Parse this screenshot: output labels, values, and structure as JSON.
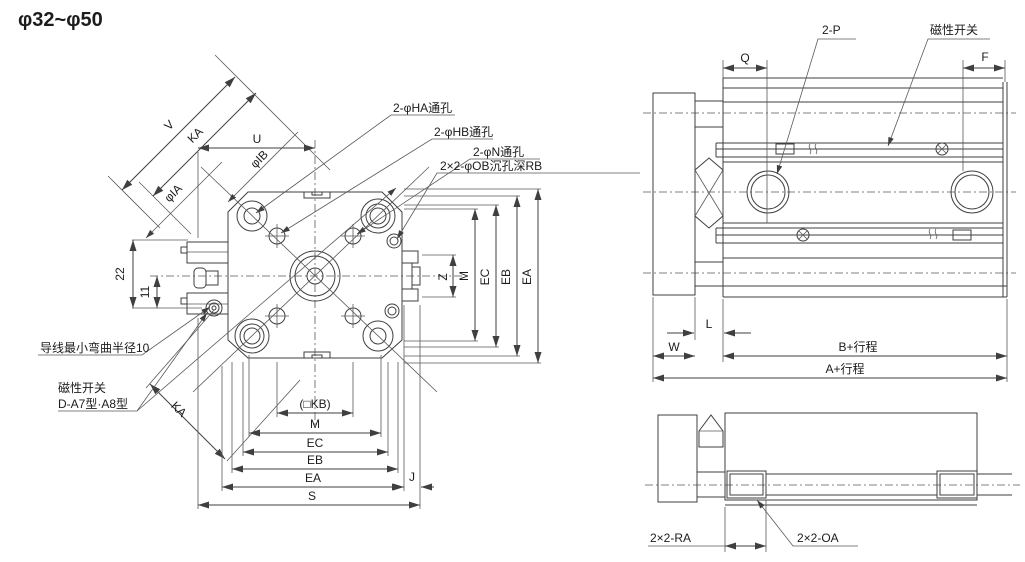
{
  "title": "φ32~φ50",
  "front_view": {
    "hole_labels": {
      "ha": "2-φHA通孔",
      "hb": "2-φHB通孔",
      "n": "2-φN通孔",
      "ob": "2×2-φOB沉孔深RB"
    },
    "annotations": {
      "wire_bend": "导线最小弯曲半径10",
      "switch_line1": "磁性开关",
      "switch_line2": "D-A7型·A8型"
    },
    "dimensions": {
      "v": "V",
      "ka_top": "KA",
      "u": "U",
      "ia": "φIA",
      "ib": "φIB",
      "d22": "22",
      "d11": "11",
      "z": "Z",
      "m_right": "M",
      "ec_right": "EC",
      "eb_right": "EB",
      "ea_right": "EA",
      "kb": "(□KB)",
      "m_bottom": "M",
      "ec_bottom": "EC",
      "eb_bottom": "EB",
      "ea_bottom": "EA",
      "j": "J",
      "s": "S",
      "ka_bottom": "KA"
    }
  },
  "side_view": {
    "labels": {
      "ports": "2-P",
      "switch": "磁性开关"
    },
    "dimensions": {
      "q": "Q",
      "f": "F",
      "l": "L",
      "w": "W",
      "b_stroke": "B+行程",
      "a_stroke": "A+行程"
    }
  },
  "bottom_view": {
    "labels": {
      "ra": "2×2-RA",
      "oa": "2×2-OA"
    }
  }
}
